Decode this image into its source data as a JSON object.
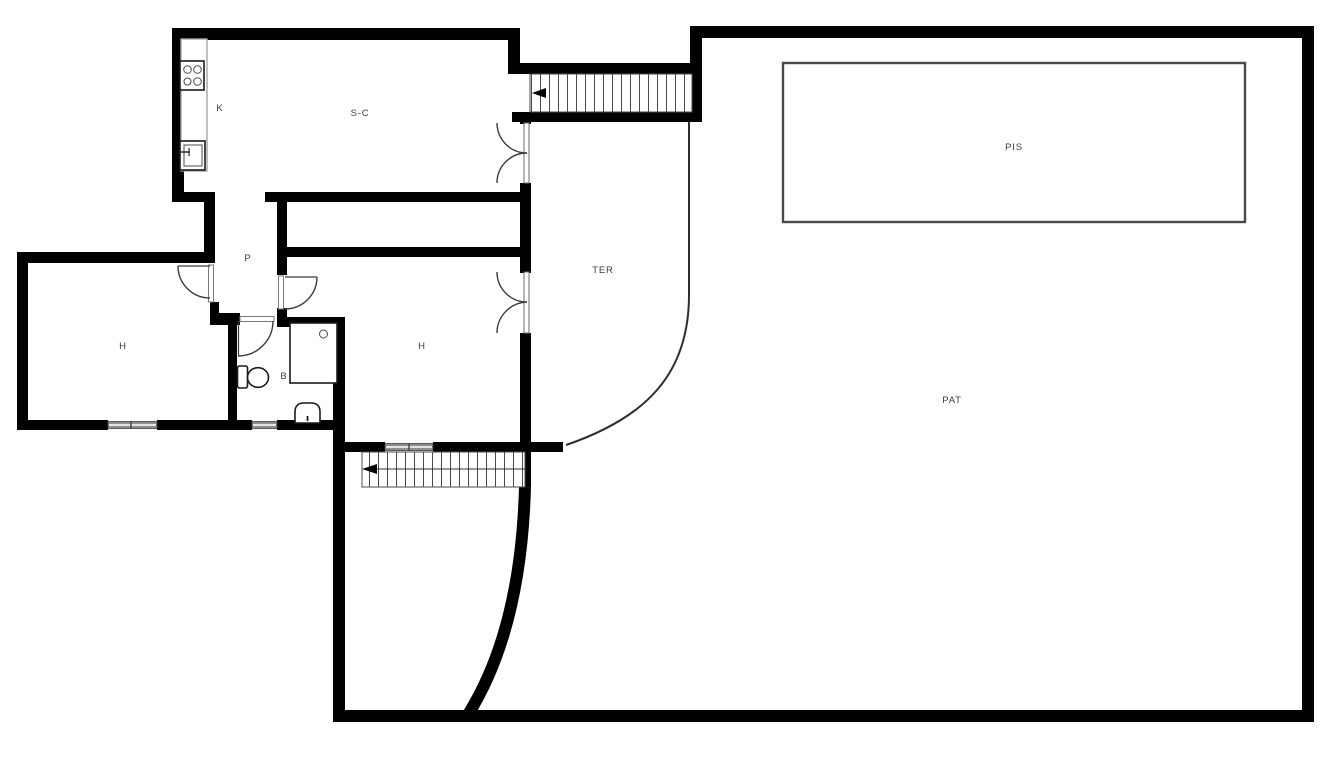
{
  "page": {
    "type": "architectural-floor-plan",
    "background_color": "#ffffff"
  },
  "colors": {
    "wall": "#010101",
    "thin_line": "#2e2e2e",
    "window": "#8f8f8f",
    "fixture_outline": "#1a1a1a",
    "label_text": "#3b3b3b",
    "counter_outline": "#a6a6a6"
  },
  "rooms": [
    {
      "id": "kitchen",
      "label": "K",
      "cx": 220,
      "cy": 108
    },
    {
      "id": "living-dining",
      "label": "S-C",
      "cx": 360,
      "cy": 113
    },
    {
      "id": "hallway",
      "label": "P",
      "cx": 248,
      "cy": 258
    },
    {
      "id": "bedroom-left",
      "label": "H",
      "cx": 123,
      "cy": 346
    },
    {
      "id": "bedroom-middle",
      "label": "H",
      "cx": 422,
      "cy": 346
    },
    {
      "id": "bathroom",
      "label": "B",
      "cx": 284,
      "cy": 376
    },
    {
      "id": "terrace",
      "label": "TER",
      "cx": 603,
      "cy": 270
    },
    {
      "id": "pool",
      "label": "PIS",
      "cx": 1014,
      "cy": 147
    },
    {
      "id": "patio",
      "label": "PAT",
      "cx": 952,
      "cy": 400
    }
  ],
  "fixtures": [
    {
      "name": "stove",
      "room": "kitchen"
    },
    {
      "name": "kitchen-sink",
      "room": "kitchen"
    },
    {
      "name": "counter",
      "room": "kitchen"
    },
    {
      "name": "shower",
      "room": "bathroom"
    },
    {
      "name": "toilet",
      "room": "bathroom"
    },
    {
      "name": "washbasin",
      "room": "bathroom"
    },
    {
      "name": "pool-basin",
      "room": "patio"
    }
  ],
  "stairs": [
    {
      "id": "stairs-top",
      "arrow_direction": "left"
    },
    {
      "id": "stairs-bottom",
      "arrow_direction": "left"
    }
  ],
  "doors": [
    {
      "id": "double-door-living-terrace"
    },
    {
      "id": "double-door-bedroom-terrace"
    },
    {
      "id": "door-hall-bedroom-left"
    },
    {
      "id": "door-hall-bedroom-middle"
    },
    {
      "id": "door-bathroom"
    }
  ],
  "windows": [
    {
      "id": "window-bedroom-left"
    },
    {
      "id": "window-bathroom"
    },
    {
      "id": "window-bedroom-middle"
    }
  ]
}
